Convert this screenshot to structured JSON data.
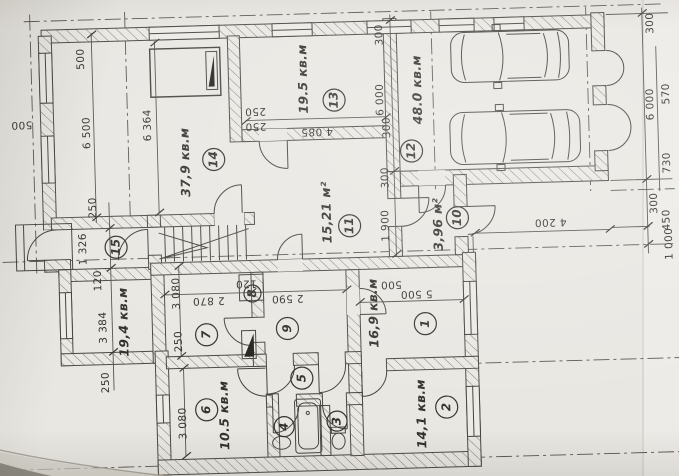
{
  "plan": {
    "rooms": {
      "r1": {
        "number": "1",
        "area": "16,9 кв.м"
      },
      "r2": {
        "number": "2",
        "area": "14,1 кв.м"
      },
      "r3": {
        "number": "3"
      },
      "r4": {
        "number": "4"
      },
      "r5": {
        "number": "5"
      },
      "r6": {
        "number": "6",
        "area": "10.5 кв.м"
      },
      "r7": {
        "number": "7"
      },
      "r8": {
        "number": "8"
      },
      "r9": {
        "number": "9"
      },
      "r10": {
        "number": "10",
        "area": "3,96 м²"
      },
      "r11": {
        "number": "11",
        "area": "15,21 м²"
      },
      "r12": {
        "number": "12",
        "area": "48.0 кв.м"
      },
      "r13": {
        "number": "13",
        "area": "19.5 кв.м"
      },
      "r14": {
        "number": "14",
        "area": "37,9 кв.м"
      },
      "r15": {
        "number": "15"
      },
      "left_room": {
        "area": "19,4 кв.м"
      }
    },
    "dims": {
      "top_left_500": "500",
      "left_wall_500": "500",
      "left_6500": "6 500",
      "room14_6364": "6 364",
      "w250_a": "250",
      "w250_b": "250",
      "room13_4085": "4 085",
      "gl_300_top": "300",
      "gl_6000": "6 000",
      "gl_300_mid": "300",
      "gl_300_low": "300",
      "hall_1900": "1 900",
      "gr_300_top": "300",
      "gr_6000": "6 000",
      "gr_570": "570",
      "gr_730": "730",
      "gr_300_low": "300",
      "gr_450": "450",
      "gr_1000": "1 000",
      "right_4200": "4 200",
      "room1_500": "500",
      "room1_5500": "5 500",
      "bl_250_top": "250",
      "bl_1326": "1 326",
      "bl_120": "120",
      "bl_3384": "3 384",
      "bl_250_low": "250",
      "r7_3080": "3 080",
      "r7_250": "250",
      "r7_2870": "2 870",
      "w120_mid": "120",
      "r9_2590": "2 590",
      "r6_3080": "3 080"
    }
  }
}
